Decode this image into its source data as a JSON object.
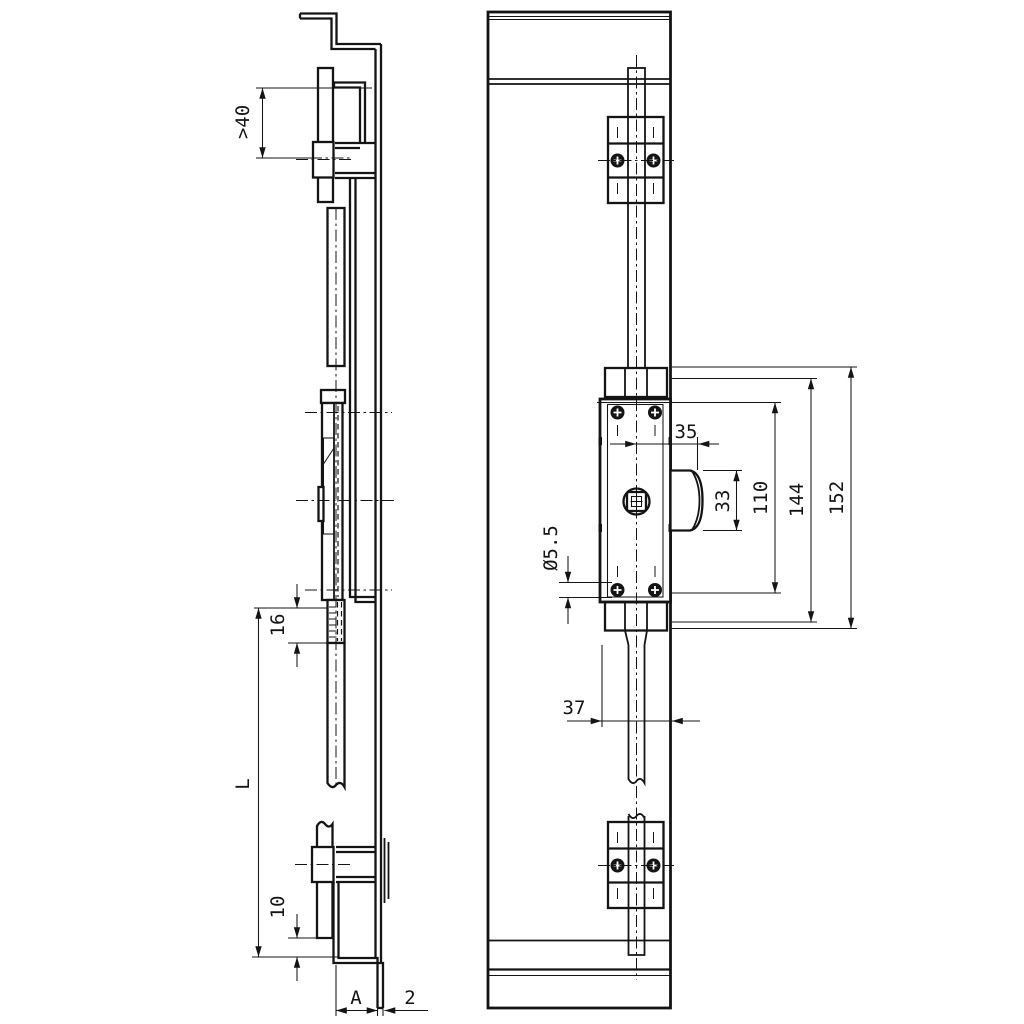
{
  "drawing": {
    "colors": {
      "line": "#141414",
      "background": "#ffffff"
    },
    "dims": {
      "side": {
        "flange_offset": ">40",
        "rod_overlap": "16",
        "length": "L",
        "bottom_offset": "10",
        "hook_width": "A",
        "sheet_thickness": "2"
      },
      "front": {
        "cam_offset": "35",
        "cam_height": "33",
        "hole_spacing": "110",
        "bracket_span": "144",
        "overall_span": "152",
        "hole_diameter": "Ø5.5",
        "backset": "37"
      }
    }
  }
}
